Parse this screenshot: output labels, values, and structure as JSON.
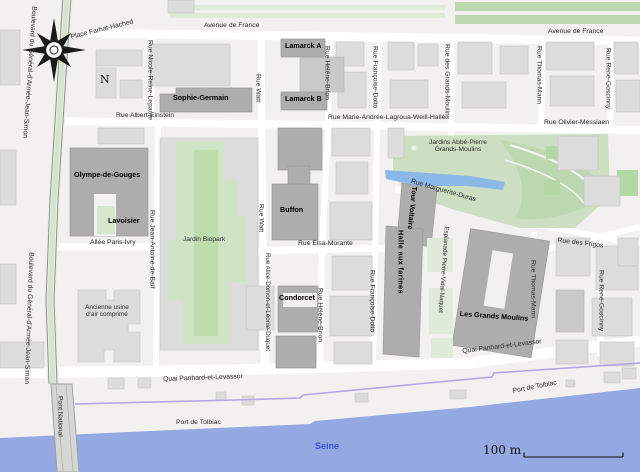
{
  "compass": {
    "north": "N"
  },
  "scale": {
    "label": "100 m"
  },
  "water": {
    "seine": "Seine",
    "port_de_tolbiac": "Port de Tolbiac",
    "pont_national": "Pont National"
  },
  "streets": {
    "avenue_de_france": "Avenue de France",
    "place_farhat_hached": "Place Farhat-Hached",
    "boulevard_general": "Boulevard du Général-d'Armée-Jean-Simon",
    "rue_nicole_reine_lepaute": "Rue Nicole-Reine-Lepaute",
    "rue_albert_einstein": "Rue Albert-Einstein",
    "rue_watt": "Rue Watt",
    "rue_helene_brion": "Rue Hélène-Brion",
    "rue_francoise_dolto": "Rue Françoise-Dolto",
    "rue_marie_andree_lagroua": "Rue Marie-Andrée-Lagroua-Weill-Hallé",
    "rue_des_grands_moulins": "Rue des Grands-Moulins",
    "rue_thomas_mann": "Rue Thomas-Mann",
    "rue_rene_goscinny": "Rue René-Goscinny",
    "rue_olivier_messiaen": "Rue Olivier-Messiaen",
    "allee_paris_ivry": "Allée Paris-Ivry",
    "rue_jean_antoine_de_baif": "Rue Jean-Antoine-de-Baïf",
    "rue_elsa_morante": "Rue Elsa-Morante",
    "rue_alice_domon": "Rue Alice-Domon-et-Léonie-Duquet",
    "rue_marguerite_duras": "Rue Marguerite-Duras",
    "esplanade_pierre_vidal_naquet": "Esplanade Pierre-Vidal-Naquet",
    "rue_des_frigos": "Rue des Frigos",
    "quai_panhard_et_levassor": "Quai Panhard-et-Levassor"
  },
  "buildings": {
    "sophie_germain": "Sophie-Germain",
    "lamarck_a": "Lamarck A",
    "lamarck_b": "Lamarck B",
    "olympe_de_gouges": "Olympe-de-Gouges",
    "lavoisier": "Lavoisier",
    "buffon": "Buffon",
    "condorcet": "Condorcet",
    "tour_voltaire": "Tour Voltaire",
    "halle_aux_farines": "Halle aux farines",
    "les_grands_moulins": "Les Grands Moulins",
    "ancienne_usine": "Ancienne usine\nd'air comprimé"
  },
  "parks": {
    "jardin_biopark": "Jardin Biopark",
    "jardins_abbe_pierre": "Jardins Abbé-Pierre\nGrands-Moulins"
  },
  "colors": {
    "background": "#f2f1ef",
    "building": "#dcdcda",
    "campus": "#adadab",
    "park": "#ccdfc3",
    "lawn": "#b4d8a5",
    "water": "#94a8e2",
    "bike_path": "#b4a6e8",
    "seine_text": "#3c55cb"
  }
}
